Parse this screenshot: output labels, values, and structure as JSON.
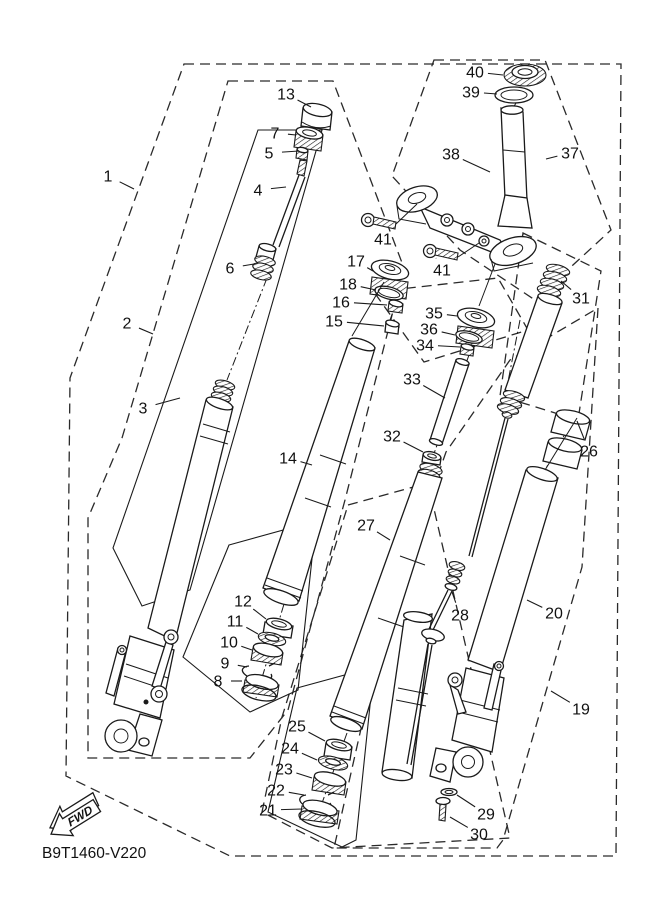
{
  "diagram": {
    "title": "front-fork-exploded-parts-diagram",
    "part_code": "B9T1460-V220",
    "fwd_label": "FWD",
    "colors": {
      "line": "#1a1a1a",
      "background": "#ffffff"
    },
    "callouts": [
      {
        "n": "1",
        "x": 108,
        "y": 176,
        "ex": 134,
        "ey": 189
      },
      {
        "n": "2",
        "x": 127,
        "y": 323,
        "ex": 153,
        "ey": 334
      },
      {
        "n": "3",
        "x": 143,
        "y": 408,
        "ex": 180,
        "ey": 398
      },
      {
        "n": "4",
        "x": 258,
        "y": 190,
        "ex": 286,
        "ey": 187
      },
      {
        "n": "5",
        "x": 269,
        "y": 153,
        "ex": 299,
        "ey": 151
      },
      {
        "n": "6",
        "x": 230,
        "y": 268,
        "ex": 254,
        "ey": 264
      },
      {
        "n": "7",
        "x": 275,
        "y": 133,
        "ex": 296,
        "ey": 135
      },
      {
        "n": "8",
        "x": 218,
        "y": 681,
        "ex": 242,
        "ey": 681
      },
      {
        "n": "9",
        "x": 225,
        "y": 663,
        "ex": 247,
        "ey": 667
      },
      {
        "n": "10",
        "x": 229,
        "y": 642,
        "ex": 252,
        "ey": 650
      },
      {
        "n": "11",
        "x": 235,
        "y": 621,
        "ex": 258,
        "ey": 634
      },
      {
        "n": "12",
        "x": 243,
        "y": 601,
        "ex": 266,
        "ey": 619
      },
      {
        "n": "13",
        "x": 286,
        "y": 94,
        "ex": 311,
        "ey": 107
      },
      {
        "n": "14",
        "x": 288,
        "y": 458,
        "ex": 312,
        "ey": 465
      },
      {
        "n": "15",
        "x": 334,
        "y": 321,
        "ex": 384,
        "ey": 326
      },
      {
        "n": "16",
        "x": 341,
        "y": 302,
        "ex": 387,
        "ey": 305
      },
      {
        "n": "17",
        "x": 356,
        "y": 261,
        "ex": 373,
        "ey": 271
      },
      {
        "n": "18",
        "x": 348,
        "y": 284,
        "ex": 376,
        "ey": 290
      },
      {
        "n": "19",
        "x": 581,
        "y": 709,
        "ex": 551,
        "ey": 691
      },
      {
        "n": "20",
        "x": 554,
        "y": 613,
        "ex": 527,
        "ey": 600
      },
      {
        "n": "21",
        "x": 268,
        "y": 810,
        "ex": 302,
        "ey": 809
      },
      {
        "n": "22",
        "x": 276,
        "y": 790,
        "ex": 304,
        "ey": 795
      },
      {
        "n": "23",
        "x": 284,
        "y": 769,
        "ex": 312,
        "ey": 778
      },
      {
        "n": "24",
        "x": 290,
        "y": 748,
        "ex": 317,
        "ey": 760
      },
      {
        "n": "25",
        "x": 297,
        "y": 726,
        "ex": 325,
        "ey": 741
      },
      {
        "n": "26",
        "x": 589,
        "y": 451,
        "ex": 577,
        "ey": 421
      },
      {
        "n": "27",
        "x": 366,
        "y": 525,
        "ex": 390,
        "ey": 540
      },
      {
        "n": "28",
        "x": 460,
        "y": 615,
        "ex": 452,
        "ey": 592
      },
      {
        "n": "29",
        "x": 486,
        "y": 814,
        "ex": 457,
        "ey": 795
      },
      {
        "n": "30",
        "x": 479,
        "y": 834,
        "ex": 450,
        "ey": 817
      },
      {
        "n": "31",
        "x": 581,
        "y": 298,
        "ex": 561,
        "ey": 281
      },
      {
        "n": "32",
        "x": 392,
        "y": 436,
        "ex": 423,
        "ey": 452
      },
      {
        "n": "33",
        "x": 412,
        "y": 379,
        "ex": 445,
        "ey": 398
      },
      {
        "n": "34",
        "x": 425,
        "y": 345,
        "ex": 460,
        "ey": 347
      },
      {
        "n": "35",
        "x": 434,
        "y": 313,
        "ex": 457,
        "ey": 316
      },
      {
        "n": "36",
        "x": 429,
        "y": 329,
        "ex": 455,
        "ey": 335
      },
      {
        "n": "37",
        "x": 570,
        "y": 153,
        "ex": 546,
        "ey": 159
      },
      {
        "n": "38",
        "x": 451,
        "y": 154,
        "ex": 490,
        "ey": 172
      },
      {
        "n": "39",
        "x": 471,
        "y": 92,
        "ex": 497,
        "ey": 94
      },
      {
        "n": "40",
        "x": 475,
        "y": 72,
        "ex": 503,
        "ey": 75
      },
      {
        "n": "41",
        "x": 383,
        "y": 239,
        "ex": 376,
        "ey": 228
      },
      {
        "n": "41",
        "x": 442,
        "y": 270,
        "ex": 436,
        "ey": 258
      }
    ]
  }
}
